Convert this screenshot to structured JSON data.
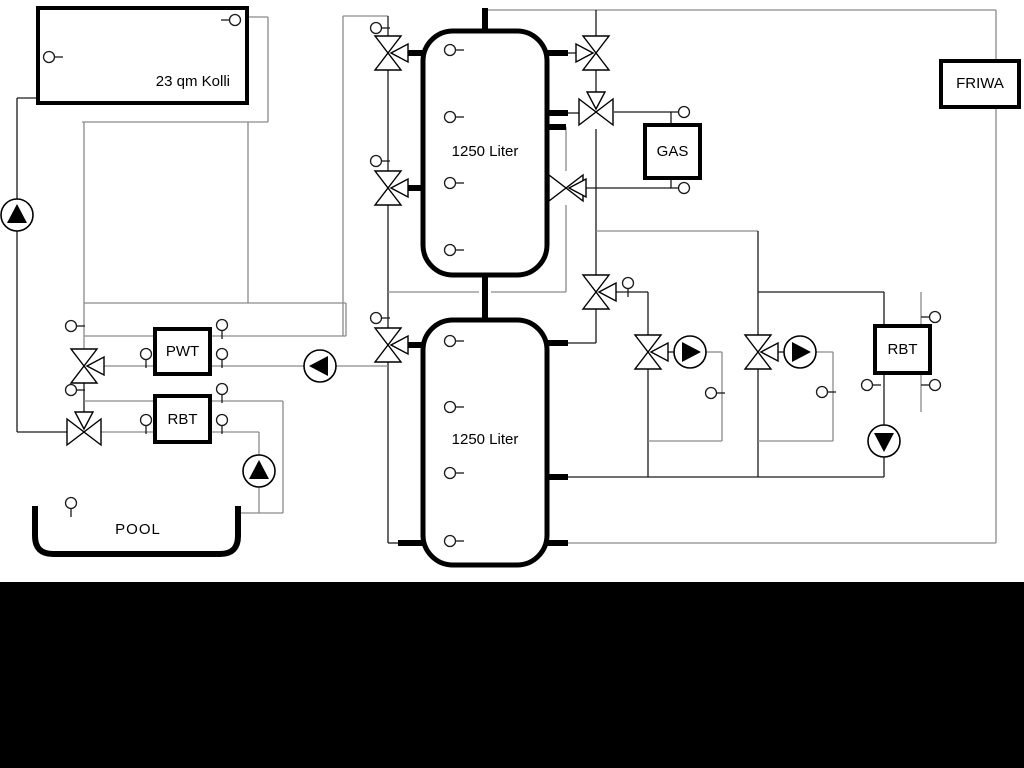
{
  "diagram": {
    "labels": {
      "collector": "23 qm Kolli",
      "tank1": "1250 Liter",
      "tank2": "1250 Liter",
      "pwt": "PWT",
      "rbt_left": "RBT",
      "gas": "GAS",
      "friwa": "FRIWA",
      "rbt_right": "RBT",
      "pool": "POOL"
    },
    "colors": {
      "background": "#ffffff",
      "footer": "#000000",
      "pipe_gray": "#8a8a8a",
      "pipe_dark": "#1a1a1a",
      "component_stroke": "#000000",
      "component_fill": "#ffffff"
    }
  }
}
